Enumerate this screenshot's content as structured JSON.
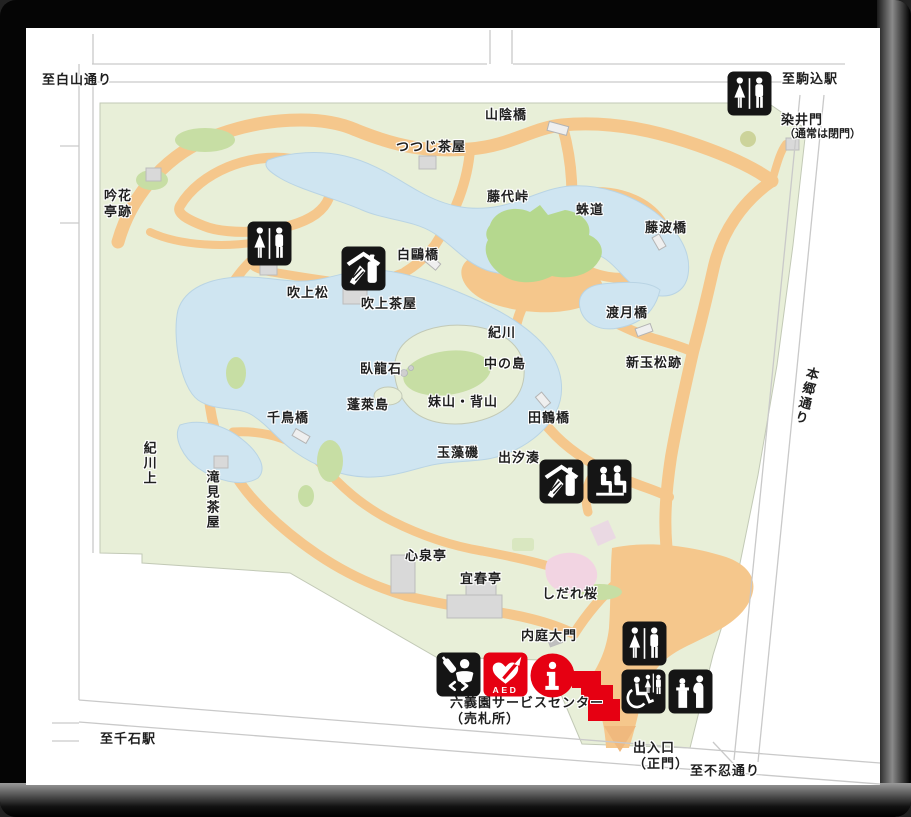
{
  "map": {
    "title": "Rikugien Garden guide map",
    "colors": {
      "park_green": "#e8efd8",
      "tree_green": "#c7dea4",
      "hill_green": "#b5d88e",
      "water_blue": "#cfe5f1",
      "path_orange": "#f5c78c",
      "building_gray": "#d9d9d9",
      "blossom_pink": "#f2d4e2",
      "accent_red": "#e60012",
      "icon_black": "#151515",
      "road_line_gray": "#c9c9c9",
      "frame_black": "#050505"
    },
    "region_labels": [
      {
        "id": "to-hakusan-dori",
        "text": "至白山通り",
        "x": 42,
        "y": 72
      },
      {
        "id": "to-komagome-station",
        "text": "至駒込駅",
        "x": 782,
        "y": 71
      },
      {
        "id": "somei-gate",
        "text": "染井門",
        "x": 781,
        "y": 112
      },
      {
        "id": "somei-gate-note",
        "text": "（通常は閉門）",
        "x": 784,
        "y": 128,
        "small": true
      },
      {
        "id": "sanin-bashi",
        "text": "山陰橋",
        "x": 485,
        "y": 107
      },
      {
        "id": "tsutsuji-chaya",
        "text": "つつじ茶屋",
        "x": 396,
        "y": 139
      },
      {
        "id": "fujishiro-toge",
        "text": "藤代峠",
        "x": 487,
        "y": 189
      },
      {
        "id": "kumo-michi",
        "text": "蛛道",
        "x": 576,
        "y": 202
      },
      {
        "id": "fujinami-bashi",
        "text": "藤波橋",
        "x": 645,
        "y": 220
      },
      {
        "id": "ginkatei-ato",
        "text": "吟花\n亭跡",
        "x": 104,
        "y": 188
      },
      {
        "id": "hakuo-bashi",
        "text": "白鷗橋",
        "x": 397,
        "y": 247
      },
      {
        "id": "fukiage-matsu",
        "text": "吹上松",
        "x": 287,
        "y": 285
      },
      {
        "id": "fukiage-chaya",
        "text": "吹上茶屋",
        "x": 361,
        "y": 296
      },
      {
        "id": "togetsu-kyo",
        "text": "渡月橋",
        "x": 606,
        "y": 305
      },
      {
        "id": "kisen",
        "text": "紀川",
        "x": 488,
        "y": 325
      },
      {
        "id": "nakano-shima",
        "text": "中の島",
        "x": 484,
        "y": 356
      },
      {
        "id": "aratama-matsu-ato",
        "text": "新玉松跡",
        "x": 626,
        "y": 355
      },
      {
        "id": "garyu-seki",
        "text": "臥龍石",
        "x": 360,
        "y": 361
      },
      {
        "id": "imoyama-seyama",
        "text": "妹山・背山",
        "x": 428,
        "y": 394
      },
      {
        "id": "horai-jima",
        "text": "蓬萊島",
        "x": 347,
        "y": 397
      },
      {
        "id": "tazuru-bashi",
        "text": "田鶴橋",
        "x": 528,
        "y": 410
      },
      {
        "id": "chidori-bashi",
        "text": "千鳥橋",
        "x": 267,
        "y": 410
      },
      {
        "id": "tamamo-iso",
        "text": "玉藻磯",
        "x": 437,
        "y": 445
      },
      {
        "id": "deshio-minato",
        "text": "出汐湊",
        "x": 498,
        "y": 450
      },
      {
        "id": "kisen-kami",
        "text": "紀川上",
        "x": 141,
        "y": 441,
        "dir": "v"
      },
      {
        "id": "takimi-chaya",
        "text": "滝見茶屋",
        "x": 204,
        "y": 470,
        "dir": "v"
      },
      {
        "id": "hongo-dori",
        "text": "本郷通り",
        "x": 798,
        "y": 366,
        "dir": "v",
        "rot": 14
      },
      {
        "id": "shinsen-tei",
        "text": "心泉亭",
        "x": 405,
        "y": 548
      },
      {
        "id": "gishun-tei",
        "text": "宜春亭",
        "x": 460,
        "y": 571
      },
      {
        "id": "shidare-zakura",
        "text": "しだれ桜",
        "x": 542,
        "y": 586
      },
      {
        "id": "naitei-daimon",
        "text": "内庭大門",
        "x": 521,
        "y": 628
      },
      {
        "id": "service-center",
        "text": "六義園サービスセンター\n（売札所）",
        "x": 450,
        "y": 695
      },
      {
        "id": "entrance-main-gate",
        "text": "出入口\n（正門）",
        "x": 633,
        "y": 740
      },
      {
        "id": "to-shinobazu-dori",
        "text": "至不忍通り",
        "x": 690,
        "y": 763
      },
      {
        "id": "to-sengoku-station",
        "text": "至千石駅",
        "x": 100,
        "y": 731
      }
    ],
    "facility_icons": [
      {
        "id": "restroom-north",
        "icon": "toilet-icon",
        "meaning": "restroom",
        "x": 247,
        "y": 221
      },
      {
        "id": "restroom-northeast",
        "icon": "toilet-icon",
        "meaning": "restroom",
        "x": 727,
        "y": 71
      },
      {
        "id": "restroom-south",
        "icon": "toilet-icon",
        "meaning": "restroom",
        "x": 622,
        "y": 621
      },
      {
        "id": "kiosk-fukiage",
        "icon": "kiosk-icon",
        "meaning": "refreshment kiosk",
        "x": 341,
        "y": 246
      },
      {
        "id": "kiosk-deshio",
        "icon": "kiosk-icon",
        "meaning": "refreshment kiosk",
        "x": 539,
        "y": 459
      },
      {
        "id": "rest-area",
        "icon": "bench-icon",
        "meaning": "rest area",
        "x": 587,
        "y": 459
      },
      {
        "id": "nursing-room",
        "icon": "nursing-icon",
        "meaning": "baby nursing room",
        "x": 436,
        "y": 652
      },
      {
        "id": "aed",
        "icon": "aed-icon",
        "meaning": "AED",
        "x": 483,
        "y": 652,
        "label": "AED"
      },
      {
        "id": "information",
        "icon": "information-icon",
        "meaning": "information desk",
        "x": 530,
        "y": 653
      },
      {
        "id": "accessible-restroom",
        "icon": "accessible-toilet-icon",
        "meaning": "accessible restroom",
        "x": 621,
        "y": 669
      },
      {
        "id": "baby-changing",
        "icon": "baby-changing-icon",
        "meaning": "baby changing table",
        "x": 668,
        "y": 669
      }
    ]
  }
}
